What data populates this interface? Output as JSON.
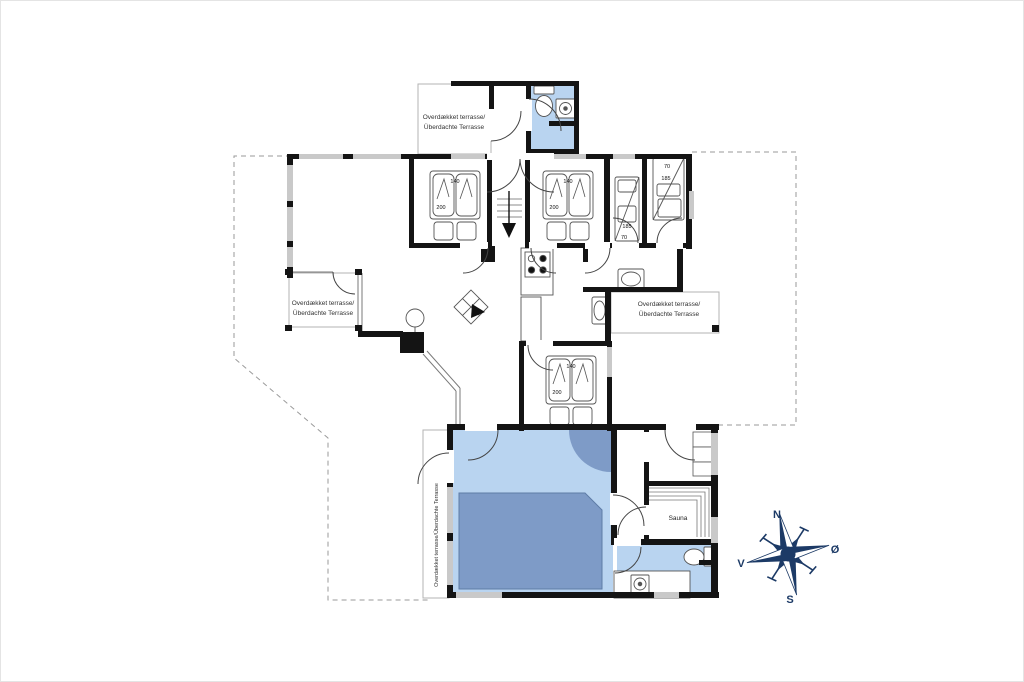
{
  "plan": {
    "labels": {
      "terrace_line1": "Overdækket terrasse/",
      "terrace_line2": "Überdachte Terrasse",
      "terrace_vertical": "Overdækket terrasse/Überdachte Terrasse",
      "sauna": "Sauna"
    },
    "dimensions": {
      "double_bed_width": "140",
      "double_bed_length": "200",
      "bunk_bed_length": "185",
      "bunk_bed_width": "70"
    },
    "compass": {
      "north": "N",
      "east": "Ø",
      "south": "S",
      "west": "V"
    },
    "colors": {
      "wet_floor": "#b9d4f0",
      "pool": "#7e9bc7",
      "wall": "#141414",
      "window": "#c9c9c9",
      "dashed_outline": "#9a9a9a",
      "compass": "#1c3a66"
    }
  }
}
